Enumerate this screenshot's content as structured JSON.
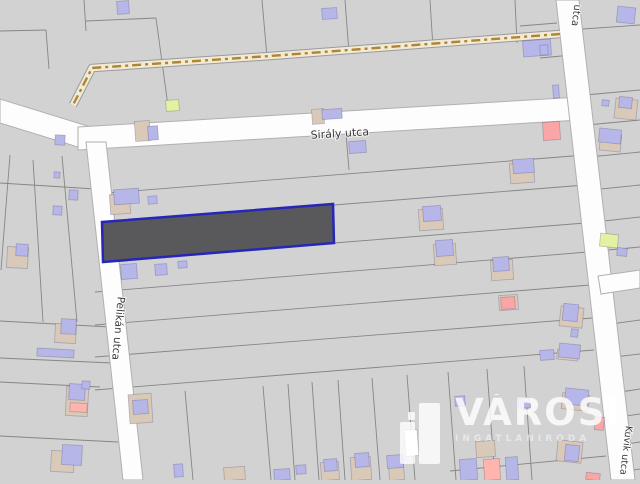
{
  "street_labels": {
    "siraly": "Sirály utca",
    "pelikan": "Pelikán utca",
    "kuvik": "Kuvik utca",
    "partial_top_right": "utca"
  },
  "watermark": {
    "title": "VÁROSI",
    "subtitle": "INGATLANIRODA"
  },
  "colors": {
    "background": "#d2d2d3",
    "parcel_line": "#868686",
    "street_fill": "#fdfdfd",
    "street_casing": "#b0b0b0",
    "track_bed": "#f1ebd5",
    "track_dash": "#b08433",
    "highlight_fill": "#59595c",
    "highlight_stroke": "#2626b8",
    "building_blue": "#b6b6e8",
    "building_tan": "#d9c9b8",
    "building_red": "#fba6a6",
    "building_lime": "#e2f2a2",
    "building_salmon": "#ffb4ae",
    "building_white": "#ffffff"
  },
  "highlight_parcel": {
    "points": "102,222 333,204 334,243 103,262"
  },
  "geometry": {
    "track_points": "560,34 270,56 92,68 73,105",
    "streets": [
      {
        "name": "street-west",
        "points": "0,99 0,123 94,152 94,128"
      },
      {
        "name": "street-siraly",
        "points": "78,127 580,97 580,120 78,150"
      },
      {
        "name": "street-pelikan",
        "points": "86,142 106,142 143,480 123,480"
      },
      {
        "name": "street-kuvik",
        "points": "556,0 579,0 635,480 611,480"
      },
      {
        "name": "street-branch-east",
        "points": "598,276 640,270 640,288 601,294"
      }
    ],
    "parcel_lines": [
      [
        0,
        31,
        46,
        30
      ],
      [
        46,
        30,
        49,
        69
      ],
      [
        84,
        0,
        86,
        31
      ],
      [
        86,
        21,
        156,
        18
      ],
      [
        156,
        18,
        168,
        106
      ],
      [
        262,
        0,
        267,
        57
      ],
      [
        345,
        0,
        349,
        53
      ],
      [
        430,
        0,
        433,
        48
      ],
      [
        515,
        0,
        517,
        43
      ],
      [
        520,
        26,
        557,
        23
      ],
      [
        583,
        29,
        640,
        25
      ],
      [
        346,
        134,
        349,
        170
      ],
      [
        540,
        58,
        572,
        55
      ],
      [
        95,
        194,
        585,
        155
      ],
      [
        334,
        205,
        585,
        185
      ],
      [
        334,
        243,
        585,
        223
      ],
      [
        95,
        292,
        588,
        252
      ],
      [
        95,
        325,
        590,
        285
      ],
      [
        95,
        357,
        592,
        318
      ],
      [
        95,
        390,
        594,
        350
      ],
      [
        185,
        391,
        193,
        480
      ],
      [
        263,
        386,
        271,
        480
      ],
      [
        288,
        384,
        295,
        480
      ],
      [
        312,
        382,
        319,
        480
      ],
      [
        338,
        380,
        345,
        480
      ],
      [
        372,
        378,
        380,
        480
      ],
      [
        407,
        375,
        415,
        480
      ],
      [
        448,
        372,
        456,
        480
      ],
      [
        487,
        369,
        495,
        480
      ],
      [
        524,
        366,
        532,
        480
      ],
      [
        450,
        471,
        606,
        456
      ],
      [
        0,
        183,
        95,
        189
      ],
      [
        33,
        160,
        43,
        322
      ],
      [
        62,
        156,
        77,
        322
      ],
      [
        0,
        321,
        110,
        327
      ],
      [
        0,
        358,
        112,
        363
      ],
      [
        0,
        382,
        100,
        387
      ],
      [
        0,
        436,
        118,
        442
      ],
      [
        10,
        155,
        1,
        270
      ],
      [
        585,
        95,
        640,
        90
      ],
      [
        587,
        125,
        640,
        120
      ],
      [
        589,
        157,
        640,
        152
      ],
      [
        591,
        190,
        640,
        185
      ],
      [
        595,
        222,
        640,
        217
      ],
      [
        597,
        251,
        640,
        247
      ],
      [
        603,
        325,
        640,
        320
      ],
      [
        605,
        358,
        640,
        354
      ],
      [
        608,
        394,
        640,
        389
      ],
      [
        611,
        418,
        640,
        414
      ],
      [
        613,
        446,
        640,
        442
      ],
      [
        615,
        473,
        640,
        469
      ]
    ],
    "buildings": [
      [
        117,
        1,
        12,
        13,
        "blue"
      ],
      [
        322,
        8,
        15,
        11,
        "blue"
      ],
      [
        523,
        40,
        28,
        16,
        "blue"
      ],
      [
        617,
        7,
        18,
        16,
        "blue"
      ],
      [
        540,
        45,
        8,
        10,
        "blue"
      ],
      [
        553,
        85,
        6,
        13,
        "blue"
      ],
      [
        543,
        122,
        17,
        18,
        "red"
      ],
      [
        166,
        100,
        13,
        11,
        "lime"
      ],
      [
        135,
        121,
        15,
        20,
        "tan"
      ],
      [
        148,
        126,
        10,
        14,
        "blue"
      ],
      [
        55,
        135,
        10,
        10,
        "blue"
      ],
      [
        312,
        109,
        12,
        15,
        "tan"
      ],
      [
        322,
        109,
        20,
        10,
        "blue"
      ],
      [
        602,
        100,
        7,
        6,
        "blue"
      ],
      [
        615,
        99,
        22,
        20,
        "tan"
      ],
      [
        619,
        97,
        13,
        11,
        "blue"
      ],
      [
        600,
        134,
        21,
        17,
        "tan"
      ],
      [
        599,
        129,
        22,
        14,
        "blue"
      ],
      [
        110,
        194,
        20,
        20,
        "tan"
      ],
      [
        114,
        189,
        25,
        15,
        "blue"
      ],
      [
        148,
        196,
        9,
        8,
        "blue"
      ],
      [
        349,
        141,
        17,
        12,
        "blue"
      ],
      [
        510,
        163,
        24,
        20,
        "tan"
      ],
      [
        513,
        159,
        21,
        14,
        "blue"
      ],
      [
        54,
        172,
        6,
        6,
        "blue"
      ],
      [
        69,
        190,
        9,
        10,
        "blue"
      ],
      [
        53,
        206,
        9,
        9,
        "blue"
      ],
      [
        7,
        247,
        21,
        21,
        "tan"
      ],
      [
        16,
        244,
        12,
        12,
        "blue"
      ],
      [
        121,
        264,
        16,
        15,
        "blue"
      ],
      [
        155,
        264,
        12,
        11,
        "blue"
      ],
      [
        178,
        261,
        9,
        7,
        "blue"
      ],
      [
        419,
        209,
        24,
        21,
        "tan"
      ],
      [
        423,
        206,
        18,
        15,
        "blue"
      ],
      [
        434,
        244,
        22,
        21,
        "tan"
      ],
      [
        436,
        240,
        17,
        16,
        "blue"
      ],
      [
        491,
        260,
        22,
        20,
        "tan"
      ],
      [
        493,
        257,
        16,
        14,
        "blue"
      ],
      [
        499,
        295,
        19,
        15,
        "tan"
      ],
      [
        501,
        297,
        14,
        12,
        "red"
      ],
      [
        600,
        234,
        18,
        13,
        "lime"
      ],
      [
        617,
        248,
        10,
        8,
        "blue"
      ],
      [
        55,
        324,
        21,
        19,
        "tan"
      ],
      [
        61,
        319,
        15,
        15,
        "blue"
      ],
      [
        37,
        349,
        37,
        8,
        "blue"
      ],
      [
        560,
        307,
        23,
        20,
        "tan"
      ],
      [
        563,
        304,
        15,
        17,
        "blue"
      ],
      [
        571,
        329,
        7,
        8,
        "blue"
      ],
      [
        557,
        350,
        21,
        10,
        "tan"
      ],
      [
        559,
        344,
        21,
        14,
        "blue"
      ],
      [
        540,
        350,
        14,
        10,
        "blue"
      ],
      [
        66,
        387,
        22,
        29,
        "tan"
      ],
      [
        69,
        384,
        16,
        16,
        "blue"
      ],
      [
        70,
        403,
        17,
        9,
        "salmon"
      ],
      [
        82,
        381,
        8,
        8,
        "blue"
      ],
      [
        129,
        394,
        23,
        29,
        "tan"
      ],
      [
        133,
        400,
        15,
        14,
        "blue"
      ],
      [
        51,
        451,
        23,
        21,
        "tan"
      ],
      [
        62,
        445,
        20,
        20,
        "blue"
      ],
      [
        174,
        464,
        9,
        13,
        "blue"
      ],
      [
        224,
        467,
        21,
        13,
        "tan"
      ],
      [
        274,
        469,
        16,
        11,
        "blue"
      ],
      [
        296,
        465,
        10,
        9,
        "blue"
      ],
      [
        321,
        462,
        18,
        18,
        "tan"
      ],
      [
        324,
        459,
        13,
        12,
        "blue"
      ],
      [
        351,
        457,
        20,
        23,
        "tan"
      ],
      [
        355,
        453,
        14,
        14,
        "blue"
      ],
      [
        389,
        463,
        15,
        17,
        "tan"
      ],
      [
        387,
        455,
        16,
        13,
        "blue"
      ],
      [
        405,
        430,
        13,
        26,
        "white"
      ],
      [
        455,
        396,
        10,
        10,
        "blue"
      ],
      [
        476,
        441,
        19,
        16,
        "tan"
      ],
      [
        460,
        459,
        17,
        21,
        "blue"
      ],
      [
        484,
        459,
        16,
        21,
        "salmon"
      ],
      [
        506,
        457,
        12,
        23,
        "blue"
      ],
      [
        562,
        394,
        27,
        16,
        "tan"
      ],
      [
        565,
        389,
        23,
        16,
        "blue"
      ],
      [
        518,
        398,
        12,
        10,
        "blue"
      ],
      [
        557,
        441,
        25,
        21,
        "tan"
      ],
      [
        565,
        445,
        14,
        16,
        "blue"
      ],
      [
        595,
        417,
        9,
        13,
        "red"
      ],
      [
        586,
        473,
        14,
        7,
        "red"
      ]
    ]
  }
}
